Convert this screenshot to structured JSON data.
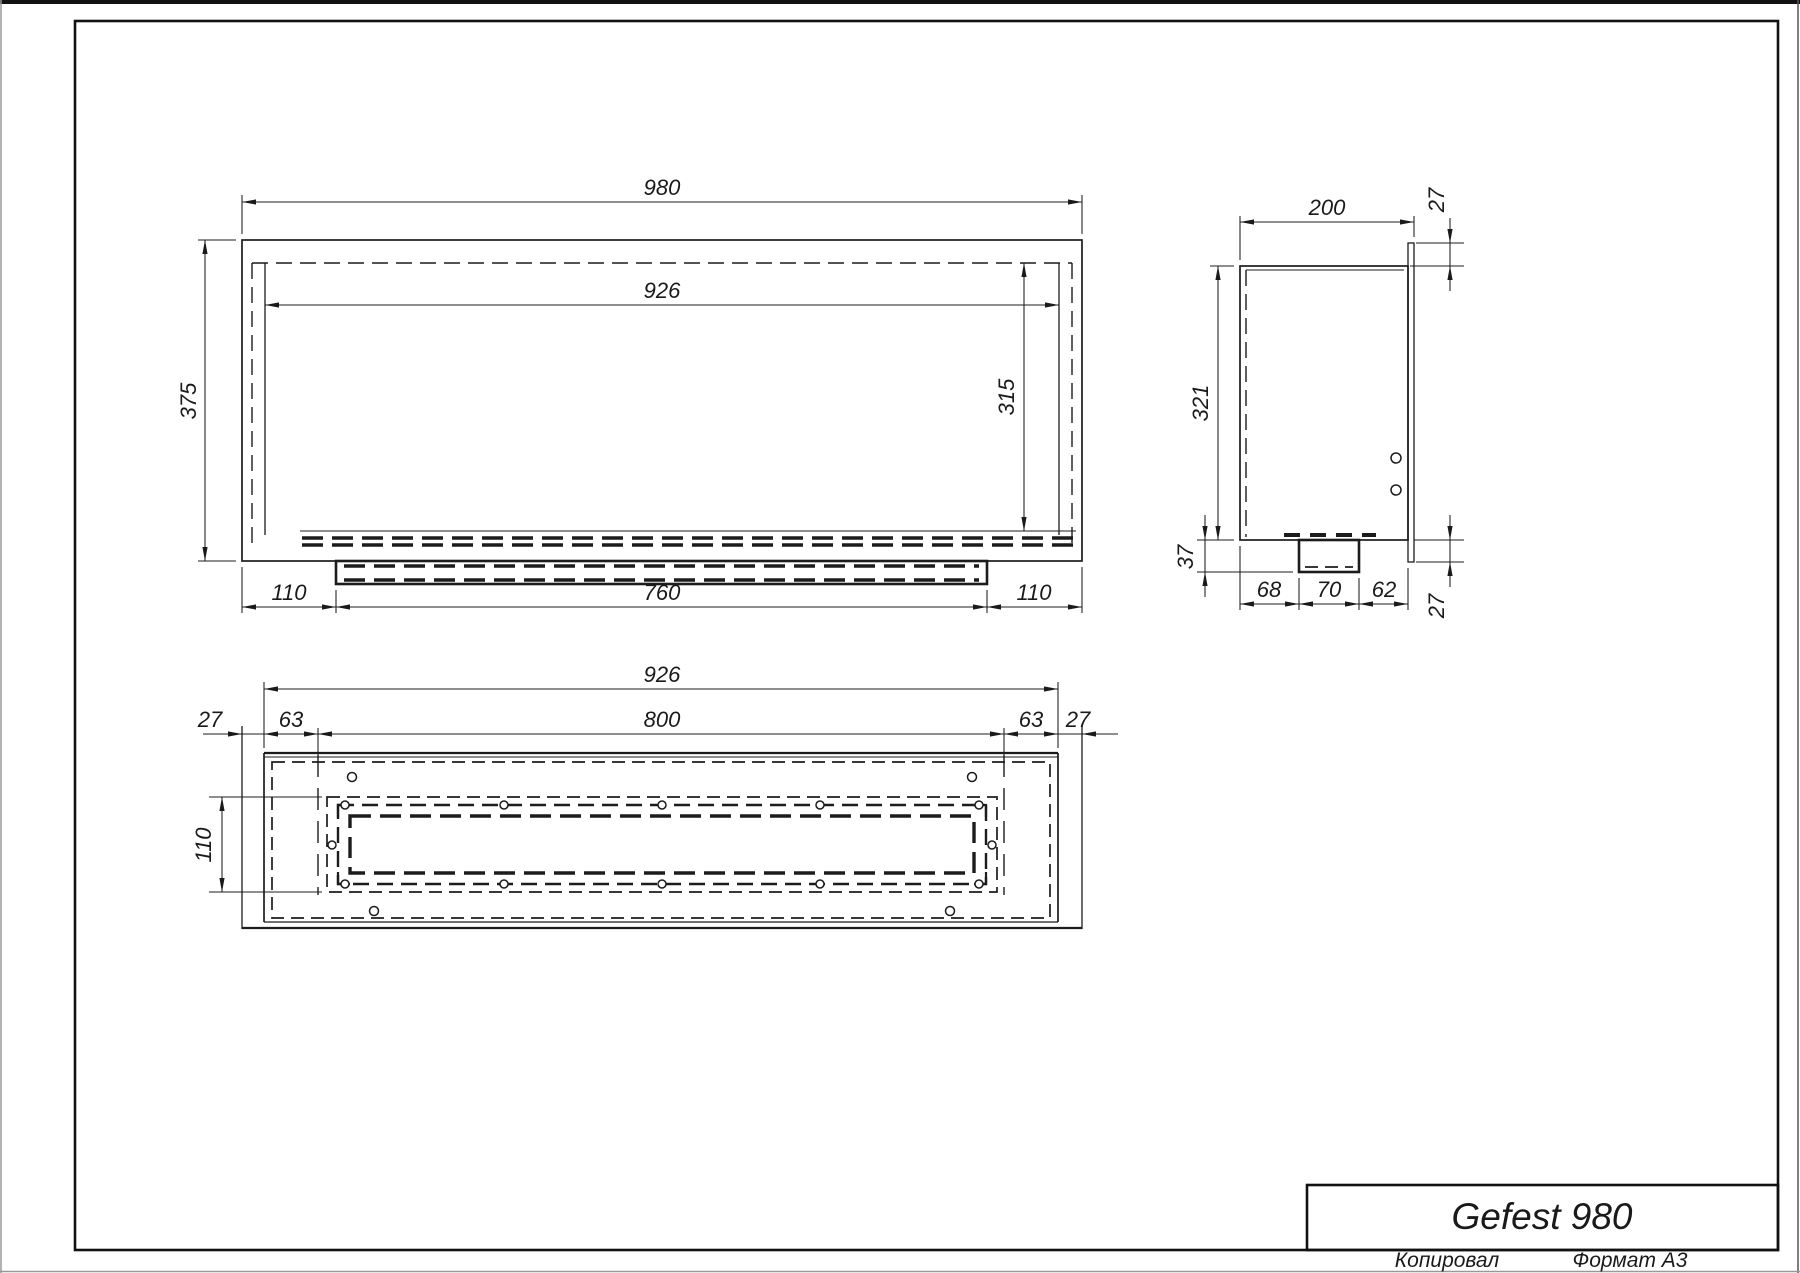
{
  "page": {
    "product_title": "Gefest 980",
    "footer": {
      "copied_label": "Копировал",
      "format_label": "Формат A3"
    }
  },
  "views": {
    "front_view": {
      "dims": {
        "overall_width": "980",
        "opening_width": "926",
        "overall_height": "375",
        "opening_height": "315",
        "left_offset": "110",
        "tray_width": "760",
        "right_offset": "110"
      }
    },
    "side_view": {
      "dims": {
        "depth": "200",
        "flange_top": "27",
        "body_height": "321",
        "tray_height": "37",
        "bottom_left": "68",
        "bottom_center": "70",
        "bottom_right": "62",
        "flange_bottom": "27"
      }
    },
    "top_view": {
      "dims": {
        "opening_width": "926",
        "slot_width": "800",
        "wall_left": "27",
        "inset_left": "63",
        "inset_right": "63",
        "wall_right": "27",
        "slot_depth": "110"
      }
    }
  }
}
